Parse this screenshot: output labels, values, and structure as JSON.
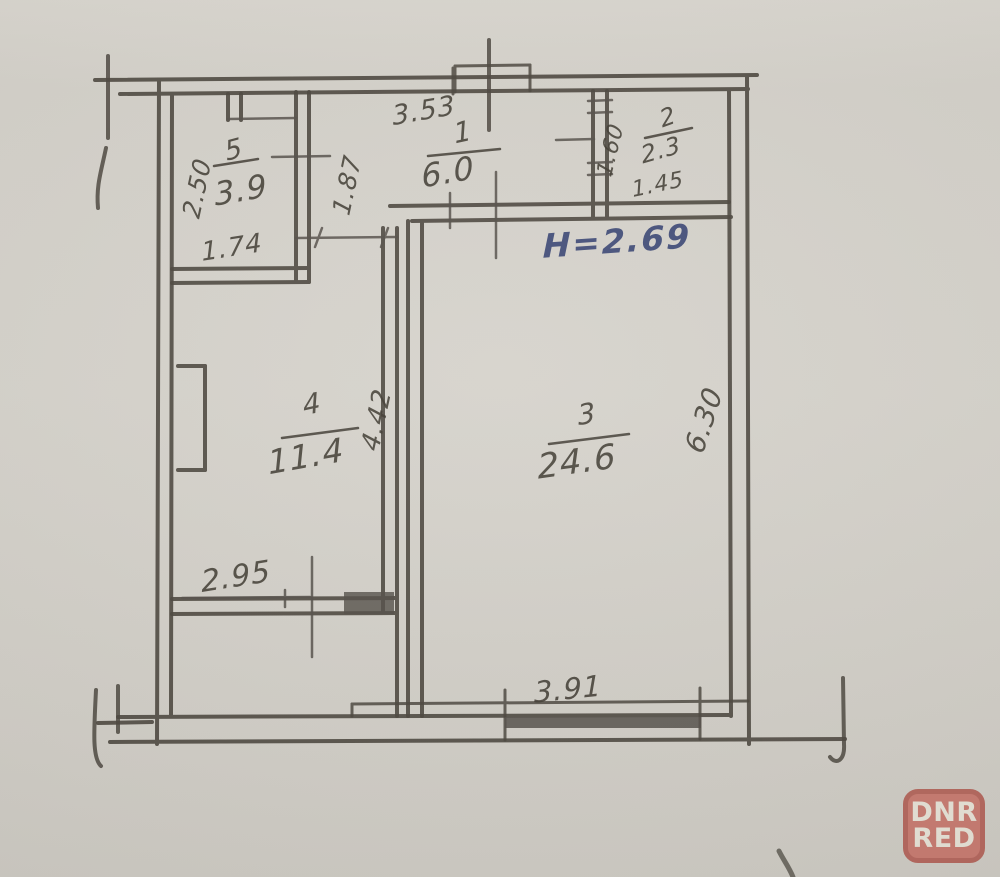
{
  "plan": {
    "height_note": "H=2.69",
    "rooms": [
      {
        "number": "1",
        "area": "6.0",
        "dims": [
          "3.53",
          "1.87"
        ]
      },
      {
        "number": "2",
        "area": "2.3",
        "dims": [
          "1.60",
          "1.45"
        ]
      },
      {
        "number": "3",
        "area": "24.6",
        "dims": [
          "6.30",
          "3.91"
        ]
      },
      {
        "number": "4",
        "area": "11.4",
        "dims": [
          "4.42",
          "2.95"
        ]
      },
      {
        "number": "5",
        "area": "3.9",
        "dims": [
          "2.50",
          "1.74"
        ]
      }
    ],
    "ink_color": "#4c473f",
    "blue_ink_color": "#46527d",
    "paper_color": "#d6d3cc"
  },
  "watermark": {
    "line1": "DNR",
    "line2": "RED",
    "background": "#c97066",
    "border_color": "#b25a50",
    "letter_color": "#ece8dc"
  }
}
